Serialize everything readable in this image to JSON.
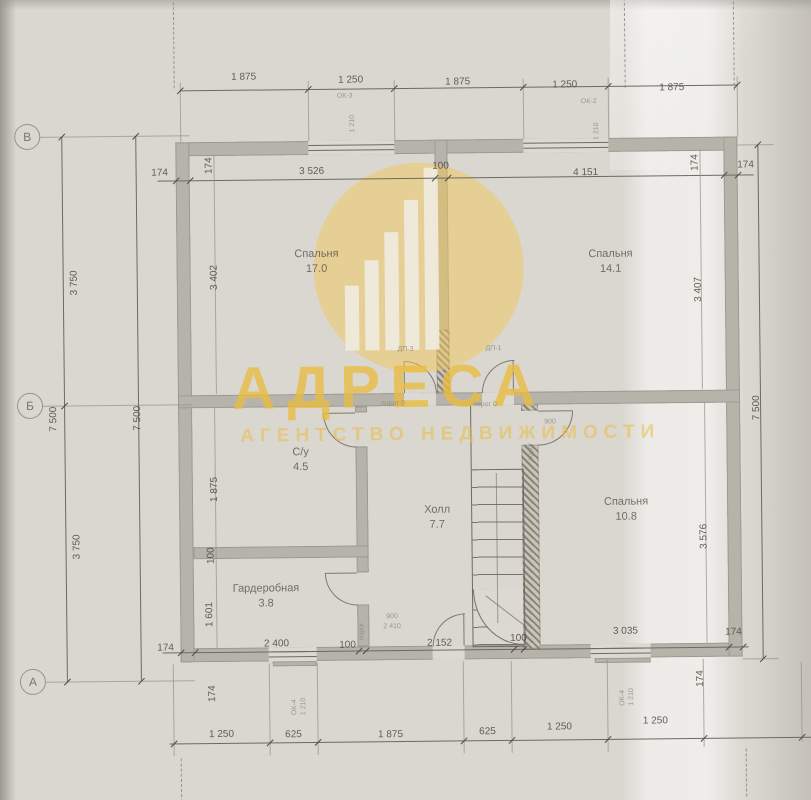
{
  "watermark": {
    "title": "АДРЕСА",
    "subtitle": "АГЕНТСТВО НЕДВИЖИМОСТИ",
    "accent_color": "#e9bc42"
  },
  "axes": {
    "top": "В",
    "middle": "Б",
    "bottom": "А"
  },
  "rooms": [
    {
      "name": "Спальня",
      "area": "17.0"
    },
    {
      "name": "Спальня",
      "area": "14.1"
    },
    {
      "name": "С/у",
      "area": "4.5"
    },
    {
      "name": "Холл",
      "area": "7.7"
    },
    {
      "name": "Гардеробная",
      "area": "3.8"
    },
    {
      "name": "Спальня",
      "area": "10.8"
    }
  ],
  "dims": {
    "top_outer": [
      "1 875",
      "1 250",
      "1 875",
      "1 250",
      "1 875"
    ],
    "top_inner": [
      "174",
      "174",
      "3 526",
      "100",
      "4 151",
      "174",
      "174"
    ],
    "left": [
      "7 500",
      "3 750",
      "3 750",
      "7 500"
    ],
    "left_inner": [
      "3 402",
      "1 875",
      "100",
      "1 601",
      "174"
    ],
    "right": [
      "7 500"
    ],
    "right_inner": [
      "3 407",
      "3 576",
      "174"
    ],
    "bottom_inner": [
      "174",
      "2 400",
      "100",
      "2 152",
      "100",
      "3 035",
      "174"
    ],
    "bottom_outer": [
      "1 250",
      "625",
      "1 875",
      "625",
      "1 250",
      "1 250"
    ]
  },
  "ann": {
    "ok3": "ОК-3",
    "ok2": "ОК-2",
    "ok4a": "ОК-4",
    "ok4b": "ОК-4",
    "n1210a": "1 210",
    "n1210b": "1 210",
    "n1210c": "1 210",
    "n1210d": "1 210",
    "porog0a": "порог 0",
    "porog0b": "порог 0",
    "porogv1": "порог",
    "porogv2": "порог",
    "dp3": "ДП-3",
    "dp1": "ДП-1",
    "d900a": "900",
    "d900b": "900",
    "d2410": "2 410"
  }
}
